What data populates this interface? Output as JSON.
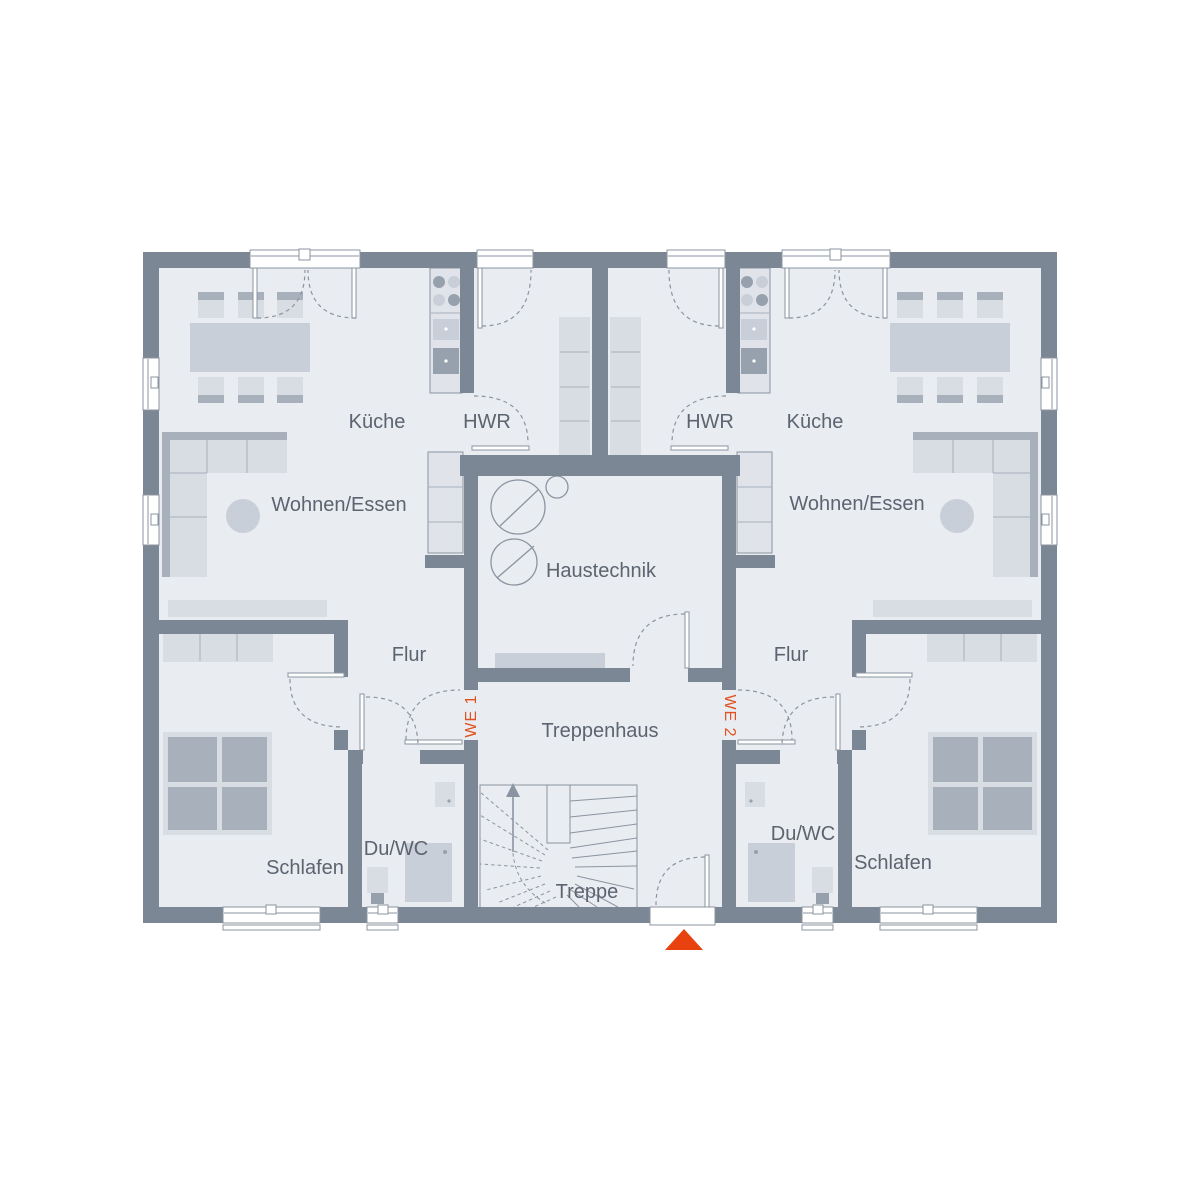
{
  "colors": {
    "wall": "#7c8795",
    "floor": "#e9ecf0",
    "furniture": "#d8dce3",
    "furniture_mid": "#c9cfd8",
    "furniture_dark": "#a8b0bc",
    "appliance_dark": "#97a1ae",
    "outline": "#8b94a1",
    "text": "#5c6471",
    "accent_orange": "#e0511f",
    "entrance_marker": "#e8430f"
  },
  "labels": {
    "kitchen_left": "Küche",
    "utility_left": "HWR",
    "living_left": "Wohnen/Essen",
    "kitchen_right": "Küche",
    "utility_right": "HWR",
    "living_right": "Wohnen/Essen",
    "technical": "Haustechnik",
    "hall_left": "Flur",
    "hall_right": "Flur",
    "stairwell": "Treppenhaus",
    "stairs": "Treppe",
    "bedroom_left": "Schlafen",
    "bedroom_right": "Schlafen",
    "bath_left": "Du/WC",
    "bath_right": "Du/WC",
    "unit1": "WE 1",
    "unit2": "WE 2"
  }
}
